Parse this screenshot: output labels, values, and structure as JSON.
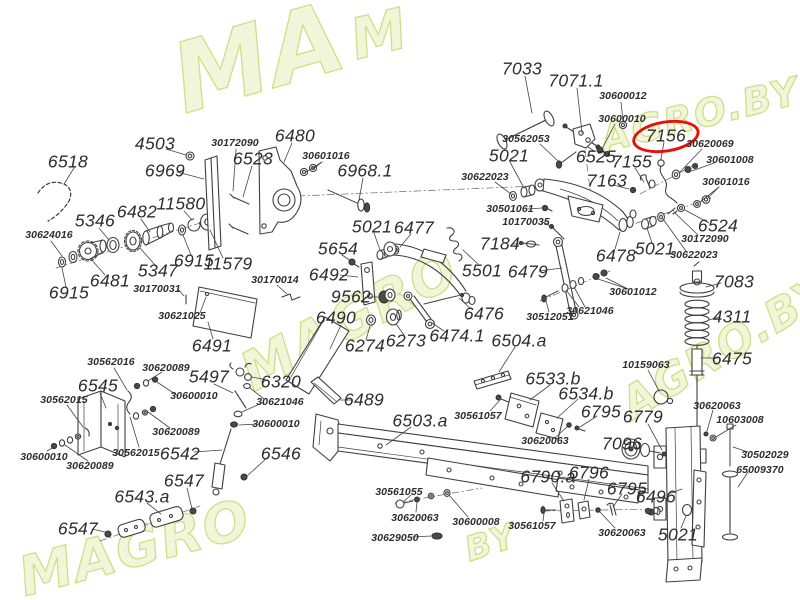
{
  "page": {
    "width": 800,
    "height": 600,
    "background": "#ffffff"
  },
  "diagram_type": "exploded-parts-diagram",
  "watermark": {
    "logo_text": "MAGRO.BY",
    "fill": "#f0f6d8",
    "stroke": "#c9dc7a",
    "instances": [
      {
        "text": "MA",
        "x": 160,
        "y": 28,
        "size": 96,
        "rot": -16
      },
      {
        "text": "M",
        "x": 344,
        "y": 10,
        "size": 56,
        "rot": -14
      },
      {
        "text": "MAGRO",
        "x": 230,
        "y": 348,
        "size": 54,
        "rot": -28
      },
      {
        "text": "AGRO.BY",
        "x": 596,
        "y": 118,
        "size": 38,
        "rot": -14
      },
      {
        "text": "AGRO.BY",
        "x": 612,
        "y": 386,
        "size": 44,
        "rot": -31
      },
      {
        "text": "MAGRO",
        "x": 12,
        "y": 548,
        "size": 54,
        "rot": -15
      },
      {
        "text": "BY",
        "x": 460,
        "y": 532,
        "size": 34,
        "rot": -18
      }
    ]
  },
  "highlight": {
    "label": "7156",
    "color": "#e41209"
  },
  "labels": [
    {
      "t": "6518",
      "x": 68,
      "y": 162,
      "s": "lg"
    },
    {
      "t": "4503",
      "x": 155,
      "y": 144,
      "s": "lg"
    },
    {
      "t": "30172090",
      "x": 235,
      "y": 143,
      "s": "sm"
    },
    {
      "t": "6523",
      "x": 253,
      "y": 159,
      "s": "lg"
    },
    {
      "t": "6480",
      "x": 295,
      "y": 136,
      "s": "lg"
    },
    {
      "t": "30601016",
      "x": 326,
      "y": 156,
      "s": "sm"
    },
    {
      "t": "6968.1",
      "x": 365,
      "y": 171,
      "s": "lg"
    },
    {
      "t": "6969",
      "x": 165,
      "y": 171,
      "s": "lg"
    },
    {
      "t": "11580",
      "x": 181,
      "y": 204,
      "s": "lg"
    },
    {
      "t": "6482",
      "x": 137,
      "y": 212,
      "s": "lg"
    },
    {
      "t": "5346",
      "x": 95,
      "y": 221,
      "s": "lg"
    },
    {
      "t": "30624016",
      "x": 49,
      "y": 235,
      "s": "sm"
    },
    {
      "t": "5347",
      "x": 158,
      "y": 271,
      "s": "lg"
    },
    {
      "t": "6915",
      "x": 194,
      "y": 261,
      "s": "lg"
    },
    {
      "t": "11579",
      "x": 228,
      "y": 264,
      "s": "lg"
    },
    {
      "t": "6481",
      "x": 110,
      "y": 281,
      "s": "lg"
    },
    {
      "t": "6915",
      "x": 69,
      "y": 293,
      "s": "lg"
    },
    {
      "t": "30170031",
      "x": 157,
      "y": 289,
      "s": "sm"
    },
    {
      "t": "30621025",
      "x": 182,
      "y": 316,
      "s": "sm"
    },
    {
      "t": "30170014",
      "x": 275,
      "y": 280,
      "s": "sm"
    },
    {
      "t": "6491",
      "x": 212,
      "y": 346,
      "s": "lg"
    },
    {
      "t": "5021",
      "x": 372,
      "y": 227,
      "s": "lg"
    },
    {
      "t": "6477",
      "x": 414,
      "y": 228,
      "s": "lg"
    },
    {
      "t": "5654",
      "x": 338,
      "y": 249,
      "s": "lg"
    },
    {
      "t": "6492",
      "x": 329,
      "y": 275,
      "s": "lg"
    },
    {
      "t": "9562",
      "x": 351,
      "y": 297,
      "s": "lg"
    },
    {
      "t": "6490",
      "x": 336,
      "y": 318,
      "s": "lg"
    },
    {
      "t": "6274",
      "x": 365,
      "y": 346,
      "s": "lg"
    },
    {
      "t": "6273",
      "x": 406,
      "y": 341,
      "s": "lg"
    },
    {
      "t": "6474.1",
      "x": 457,
      "y": 336,
      "s": "lg"
    },
    {
      "t": "6476",
      "x": 484,
      "y": 314,
      "s": "lg"
    },
    {
      "t": "5501",
      "x": 482,
      "y": 271,
      "s": "lg"
    },
    {
      "t": "6489",
      "x": 364,
      "y": 400,
      "s": "lg"
    },
    {
      "t": "7033",
      "x": 522,
      "y": 69,
      "s": "lg"
    },
    {
      "t": "7071.1",
      "x": 576,
      "y": 81,
      "s": "lg"
    },
    {
      "t": "30600012",
      "x": 623,
      "y": 96,
      "s": "sm"
    },
    {
      "t": "30600010",
      "x": 622,
      "y": 119,
      "s": "sm"
    },
    {
      "t": "30562053",
      "x": 526,
      "y": 139,
      "s": "sm"
    },
    {
      "t": "6525",
      "x": 596,
      "y": 157,
      "s": "lg"
    },
    {
      "t": "7155",
      "x": 632,
      "y": 162,
      "s": "lg"
    },
    {
      "t": "7156",
      "x": 666,
      "y": 136,
      "s": "lg",
      "hl": true
    },
    {
      "t": "30620069",
      "x": 710,
      "y": 144,
      "s": "sm"
    },
    {
      "t": "30601008",
      "x": 730,
      "y": 160,
      "s": "sm"
    },
    {
      "t": "30601016",
      "x": 726,
      "y": 182,
      "s": "sm"
    },
    {
      "t": "7163",
      "x": 607,
      "y": 181,
      "s": "lg"
    },
    {
      "t": "5021",
      "x": 509,
      "y": 156,
      "s": "lg"
    },
    {
      "t": "30622023",
      "x": 485,
      "y": 177,
      "s": "sm"
    },
    {
      "t": "30501061",
      "x": 510,
      "y": 209,
      "s": "sm"
    },
    {
      "t": "10170035",
      "x": 526,
      "y": 222,
      "s": "sm"
    },
    {
      "t": "6524",
      "x": 718,
      "y": 226,
      "s": "lg"
    },
    {
      "t": "30172090",
      "x": 705,
      "y": 239,
      "s": "sm"
    },
    {
      "t": "30622023",
      "x": 694,
      "y": 255,
      "s": "sm"
    },
    {
      "t": "5021",
      "x": 655,
      "y": 249,
      "s": "lg"
    },
    {
      "t": "7184",
      "x": 500,
      "y": 244,
      "s": "lg"
    },
    {
      "t": "6479",
      "x": 528,
      "y": 272,
      "s": "lg"
    },
    {
      "t": "6478",
      "x": 616,
      "y": 256,
      "s": "lg"
    },
    {
      "t": "30601012",
      "x": 633,
      "y": 292,
      "s": "sm"
    },
    {
      "t": "30621046",
      "x": 590,
      "y": 311,
      "s": "sm"
    },
    {
      "t": "30512051",
      "x": 550,
      "y": 317,
      "s": "sm"
    },
    {
      "t": "7083",
      "x": 734,
      "y": 282,
      "s": "lg"
    },
    {
      "t": "4311",
      "x": 732,
      "y": 317,
      "s": "lg"
    },
    {
      "t": "6475",
      "x": 732,
      "y": 359,
      "s": "lg"
    },
    {
      "t": "10159063",
      "x": 646,
      "y": 365,
      "s": "sm"
    },
    {
      "t": "6504.a",
      "x": 519,
      "y": 341,
      "s": "lg"
    },
    {
      "t": "6533.b",
      "x": 553,
      "y": 379,
      "s": "lg"
    },
    {
      "t": "6534.b",
      "x": 586,
      "y": 394,
      "s": "lg"
    },
    {
      "t": "6795",
      "x": 601,
      "y": 412,
      "s": "lg"
    },
    {
      "t": "30561057",
      "x": 478,
      "y": 416,
      "s": "sm"
    },
    {
      "t": "30620063",
      "x": 545,
      "y": 441,
      "s": "sm"
    },
    {
      "t": "6779",
      "x": 643,
      "y": 417,
      "s": "lg"
    },
    {
      "t": "7096",
      "x": 622,
      "y": 444,
      "s": "lg"
    },
    {
      "t": "30620063",
      "x": 717,
      "y": 406,
      "s": "sm"
    },
    {
      "t": "10603008",
      "x": 740,
      "y": 420,
      "s": "sm"
    },
    {
      "t": "30502029",
      "x": 765,
      "y": 455,
      "s": "sm"
    },
    {
      "t": "65009370",
      "x": 760,
      "y": 470,
      "s": "sm"
    },
    {
      "t": "6790.a",
      "x": 548,
      "y": 477,
      "s": "lg"
    },
    {
      "t": "6796",
      "x": 589,
      "y": 473,
      "s": "lg"
    },
    {
      "t": "6795",
      "x": 627,
      "y": 489,
      "s": "lg"
    },
    {
      "t": "6496",
      "x": 656,
      "y": 497,
      "s": "lg"
    },
    {
      "t": "30561057",
      "x": 532,
      "y": 526,
      "s": "sm"
    },
    {
      "t": "30620063",
      "x": 622,
      "y": 533,
      "s": "sm"
    },
    {
      "t": "5021",
      "x": 678,
      "y": 535,
      "s": "lg"
    },
    {
      "t": "6503.a",
      "x": 420,
      "y": 421,
      "s": "lg"
    },
    {
      "t": "30561055",
      "x": 399,
      "y": 492,
      "s": "sm"
    },
    {
      "t": "30620063",
      "x": 415,
      "y": 518,
      "s": "sm"
    },
    {
      "t": "30600008",
      "x": 476,
      "y": 522,
      "s": "sm"
    },
    {
      "t": "30629050",
      "x": 395,
      "y": 538,
      "s": "sm"
    },
    {
      "t": "30562016",
      "x": 111,
      "y": 362,
      "s": "sm"
    },
    {
      "t": "30620089",
      "x": 166,
      "y": 368,
      "s": "sm"
    },
    {
      "t": "6545",
      "x": 98,
      "y": 386,
      "s": "lg"
    },
    {
      "t": "30562015",
      "x": 64,
      "y": 400,
      "s": "sm"
    },
    {
      "t": "30600010",
      "x": 194,
      "y": 396,
      "s": "sm"
    },
    {
      "t": "5497",
      "x": 209,
      "y": 377,
      "s": "lg"
    },
    {
      "t": "6320",
      "x": 281,
      "y": 382,
      "s": "lg"
    },
    {
      "t": "30621046",
      "x": 280,
      "y": 402,
      "s": "sm"
    },
    {
      "t": "30600010",
      "x": 276,
      "y": 424,
      "s": "sm"
    },
    {
      "t": "30620089",
      "x": 176,
      "y": 432,
      "s": "sm"
    },
    {
      "t": "30562015",
      "x": 136,
      "y": 453,
      "s": "sm"
    },
    {
      "t": "6542",
      "x": 180,
      "y": 454,
      "s": "lg"
    },
    {
      "t": "6546",
      "x": 281,
      "y": 454,
      "s": "lg"
    },
    {
      "t": "30600010",
      "x": 44,
      "y": 457,
      "s": "sm"
    },
    {
      "t": "30620089",
      "x": 90,
      "y": 466,
      "s": "sm"
    },
    {
      "t": "6547",
      "x": 184,
      "y": 481,
      "s": "lg"
    },
    {
      "t": "6543.a",
      "x": 142,
      "y": 497,
      "s": "lg"
    },
    {
      "t": "6547",
      "x": 78,
      "y": 529,
      "s": "lg"
    }
  ]
}
